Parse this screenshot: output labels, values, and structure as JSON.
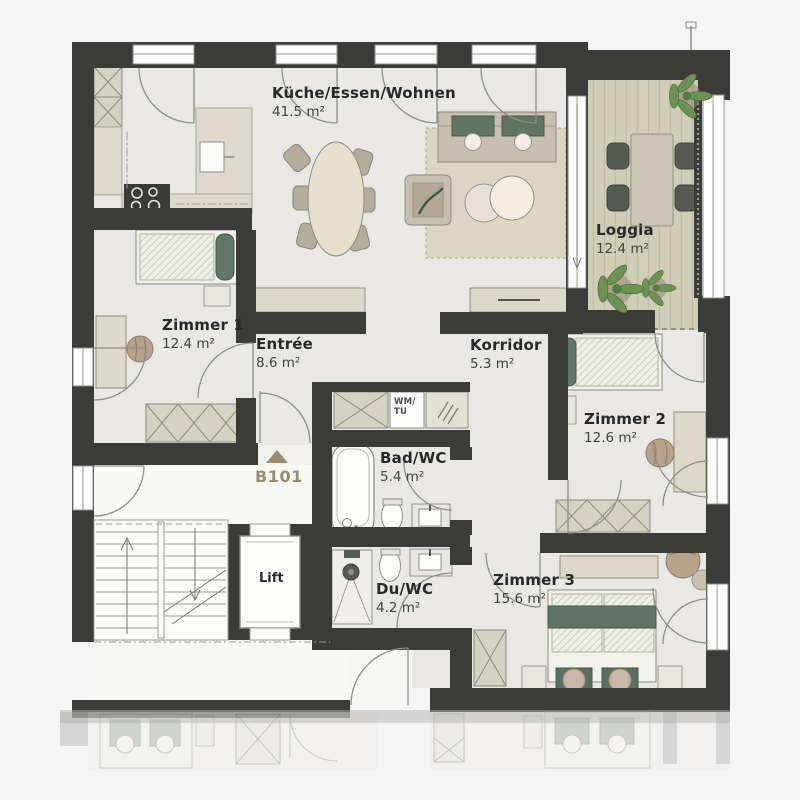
{
  "unit": {
    "id": "B101"
  },
  "rooms": {
    "kueche": {
      "name": "Küche/Essen/Wohnen",
      "area": "41.5 m²"
    },
    "loggia": {
      "name": "Loggia",
      "area": "12.4 m²"
    },
    "zimmer1": {
      "name": "Zimmer 1",
      "area": "12.4 m²"
    },
    "entree": {
      "name": "Entrée",
      "area": "8.6 m²"
    },
    "korridor": {
      "name": "Korridor",
      "area": "5.3 m²"
    },
    "zimmer2": {
      "name": "Zimmer 2",
      "area": "12.6 m²"
    },
    "bad": {
      "name": "Bad/WC",
      "area": "5.4 m²"
    },
    "du": {
      "name": "Du/WC",
      "area": "4.2 m²"
    },
    "zimmer3": {
      "name": "Zimmer 3",
      "area": "15.6 m²"
    },
    "lift": {
      "name": "Lift"
    }
  },
  "appliances": {
    "wm_tu_line1": "WM/",
    "wm_tu_line2": "TU"
  },
  "colors": {
    "wall": "#3b3b3a",
    "floor": "#e9e8e4",
    "background": "#f5f5f6",
    "loggia_deck": "#d1ceb7",
    "accent_green": "#5f7464",
    "furniture_beige": "#d9d5c4",
    "unit_label": "#9c8a6e",
    "plant_green": "#6e9254"
  }
}
